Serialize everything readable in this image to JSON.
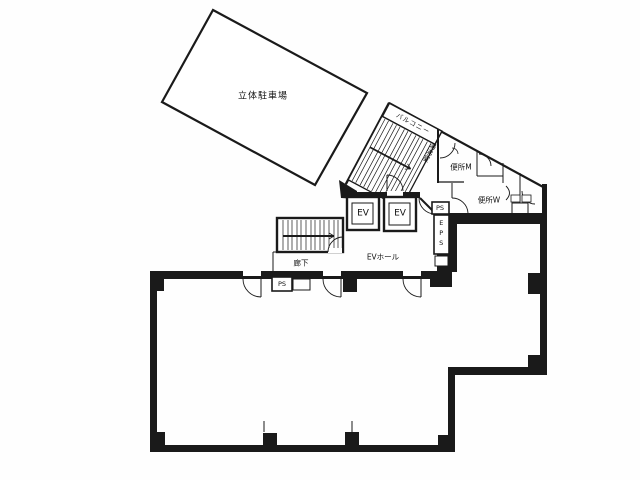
{
  "labels": {
    "parking": "立体駐車場",
    "balcony": "バルコニー",
    "kitchenette": "湯沸室",
    "toilet_m": "便所M",
    "toilet_w": "便所W",
    "elevator_1": "EV",
    "elevator_2": "EV",
    "elevator_hall": "EVホール",
    "corridor": "廊下",
    "pipe_shaft_upper": "PS",
    "electrical_pipe_shaft": "EPS",
    "pipe_shaft_lower": "PS"
  },
  "colors": {
    "background": "#fefefe",
    "line": "#1a1a1a"
  }
}
